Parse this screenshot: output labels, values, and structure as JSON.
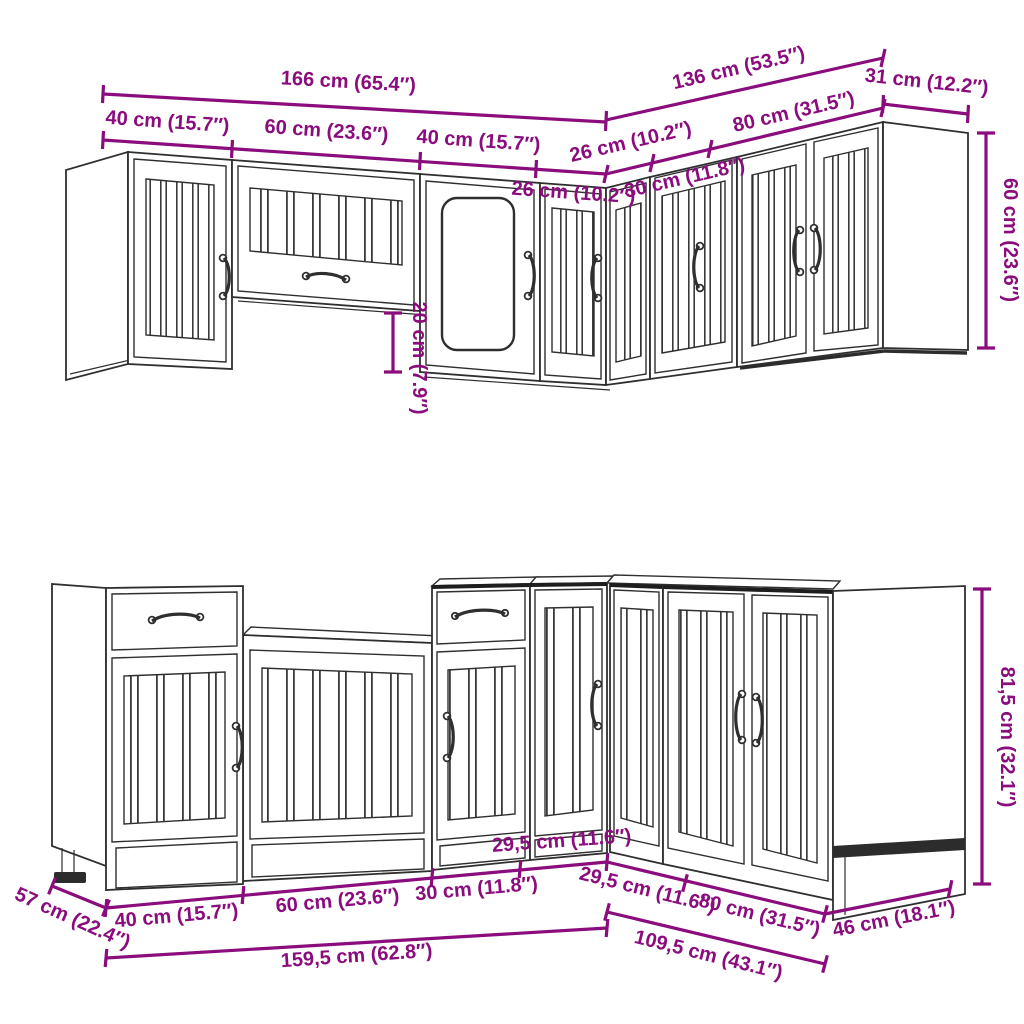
{
  "diagram": {
    "kind": "kitchen-cabinet-set-dimension-diagram",
    "style": {
      "dimension_color": "#8A0C7D",
      "line_color": "#2f2f2f",
      "background": "#ffffff"
    }
  },
  "wall_units": {
    "total_width": "166 cm (65.4″)",
    "corner_total_width": "136 cm (53.5″)",
    "end_panel_depth": "31 cm (12.2″)",
    "height": "60 cm (23.6″)",
    "bridge_clearance": "20 cm (7.9″)",
    "front_segments": [
      "40 cm (15.7″)",
      "60 cm (23.6″)",
      "40 cm (15.7″)",
      "26 cm (10.2″)"
    ],
    "corner_segments": [
      "26 cm (10.2″)",
      "30 cm (11.8″)",
      "80 cm (31.5″)"
    ]
  },
  "base_units": {
    "height": "81,5 cm (32.1″)",
    "depth_left": "57 cm (22.4″)",
    "depth_right": "46 cm (18.1″)",
    "front_total": "159,5 cm (62.8″)",
    "corner_total": "109,5 cm (43.1″)",
    "front_segments": [
      "40 cm (15.7″)",
      "60 cm (23.6″)",
      "30 cm (11.8″)",
      "29,5 cm (11.6″)"
    ],
    "corner_segments": [
      "29,5 cm (11.6″)",
      "80 cm (31.5″)"
    ]
  }
}
